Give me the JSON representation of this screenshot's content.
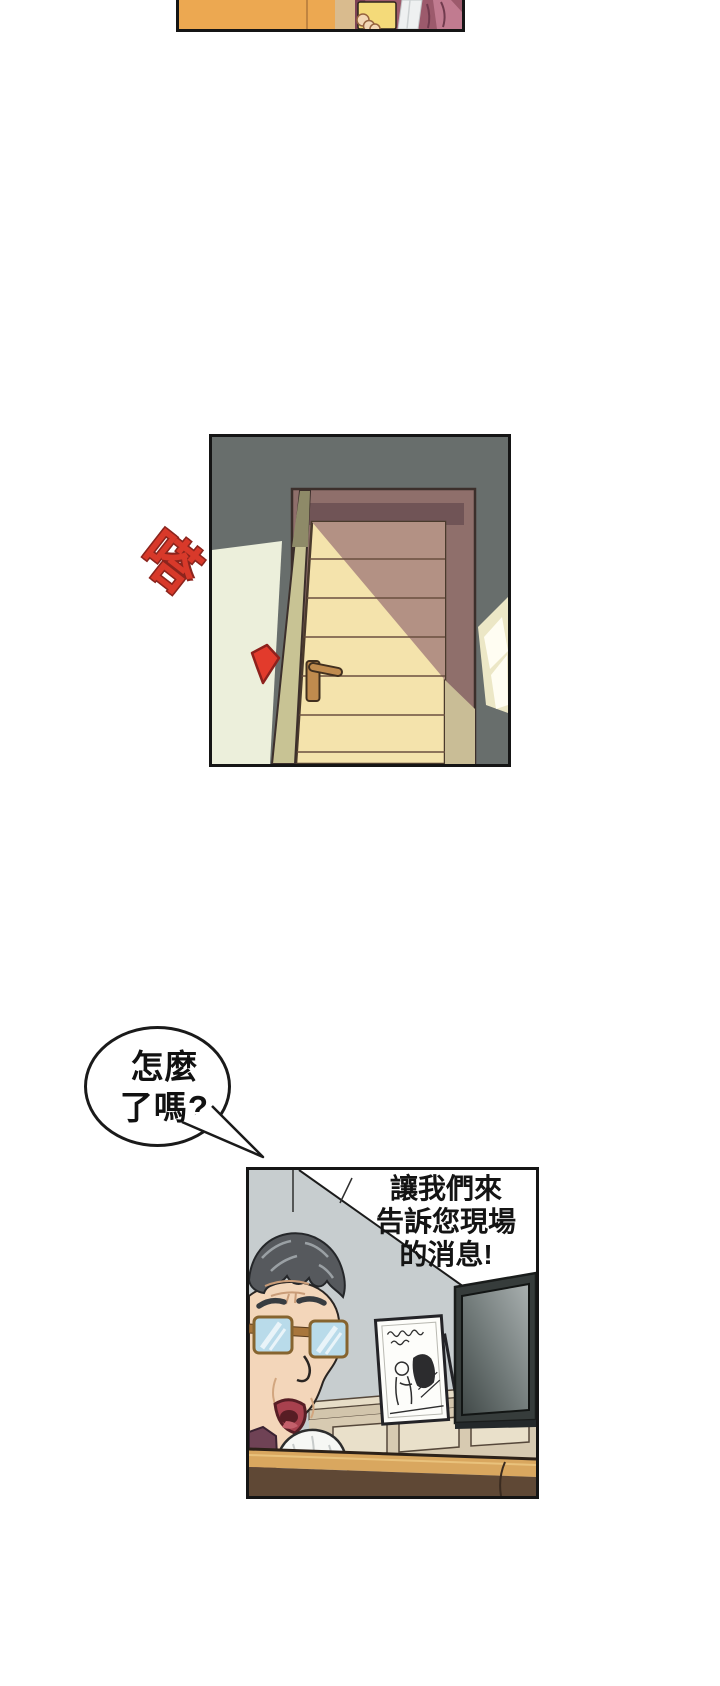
{
  "comic": {
    "sfx_door": {
      "text": "嗒",
      "color": "#d8392a",
      "outline_color": "#8c241d"
    },
    "speech_bubble": {
      "lines": [
        "怎麼",
        "了嗎?"
      ]
    },
    "broadcast_caption": {
      "lines": [
        "讓我們來",
        "告訴您現場",
        "的消息!"
      ]
    },
    "palette": {
      "page_background": "#ffffff",
      "panel_border": "#151515",
      "top_panel_wardrobe_orange": "#eca851",
      "robe_maroon": "#9c5a6c",
      "phone_yellow": "#f4da79",
      "door_wall_dark_gray": "#686e6c",
      "door_wall_pale": "#ecefdb",
      "door_frame_mauve": "#8f6f6b",
      "door_lit_yellow": "#f4e3ac",
      "door_shadow_rose": "#b39184",
      "door_jamb_khaki": "#c8c394",
      "door_handle_gold": "#c08b4e",
      "sfx_red": "#d8392a",
      "tv_room_wall_gray": "#c7cdcf",
      "tv_frame_charcoal": "#363c3b",
      "sideboard_tan": "#d7cab1",
      "table_top_tan": "#d9a75f",
      "table_front_brown": "#5f4835",
      "hair_gray": "#56595d",
      "skin_tone": "#f3d6ba",
      "glasses_blue": "#b9dbea",
      "shirt_plum": "#6f4255"
    }
  }
}
